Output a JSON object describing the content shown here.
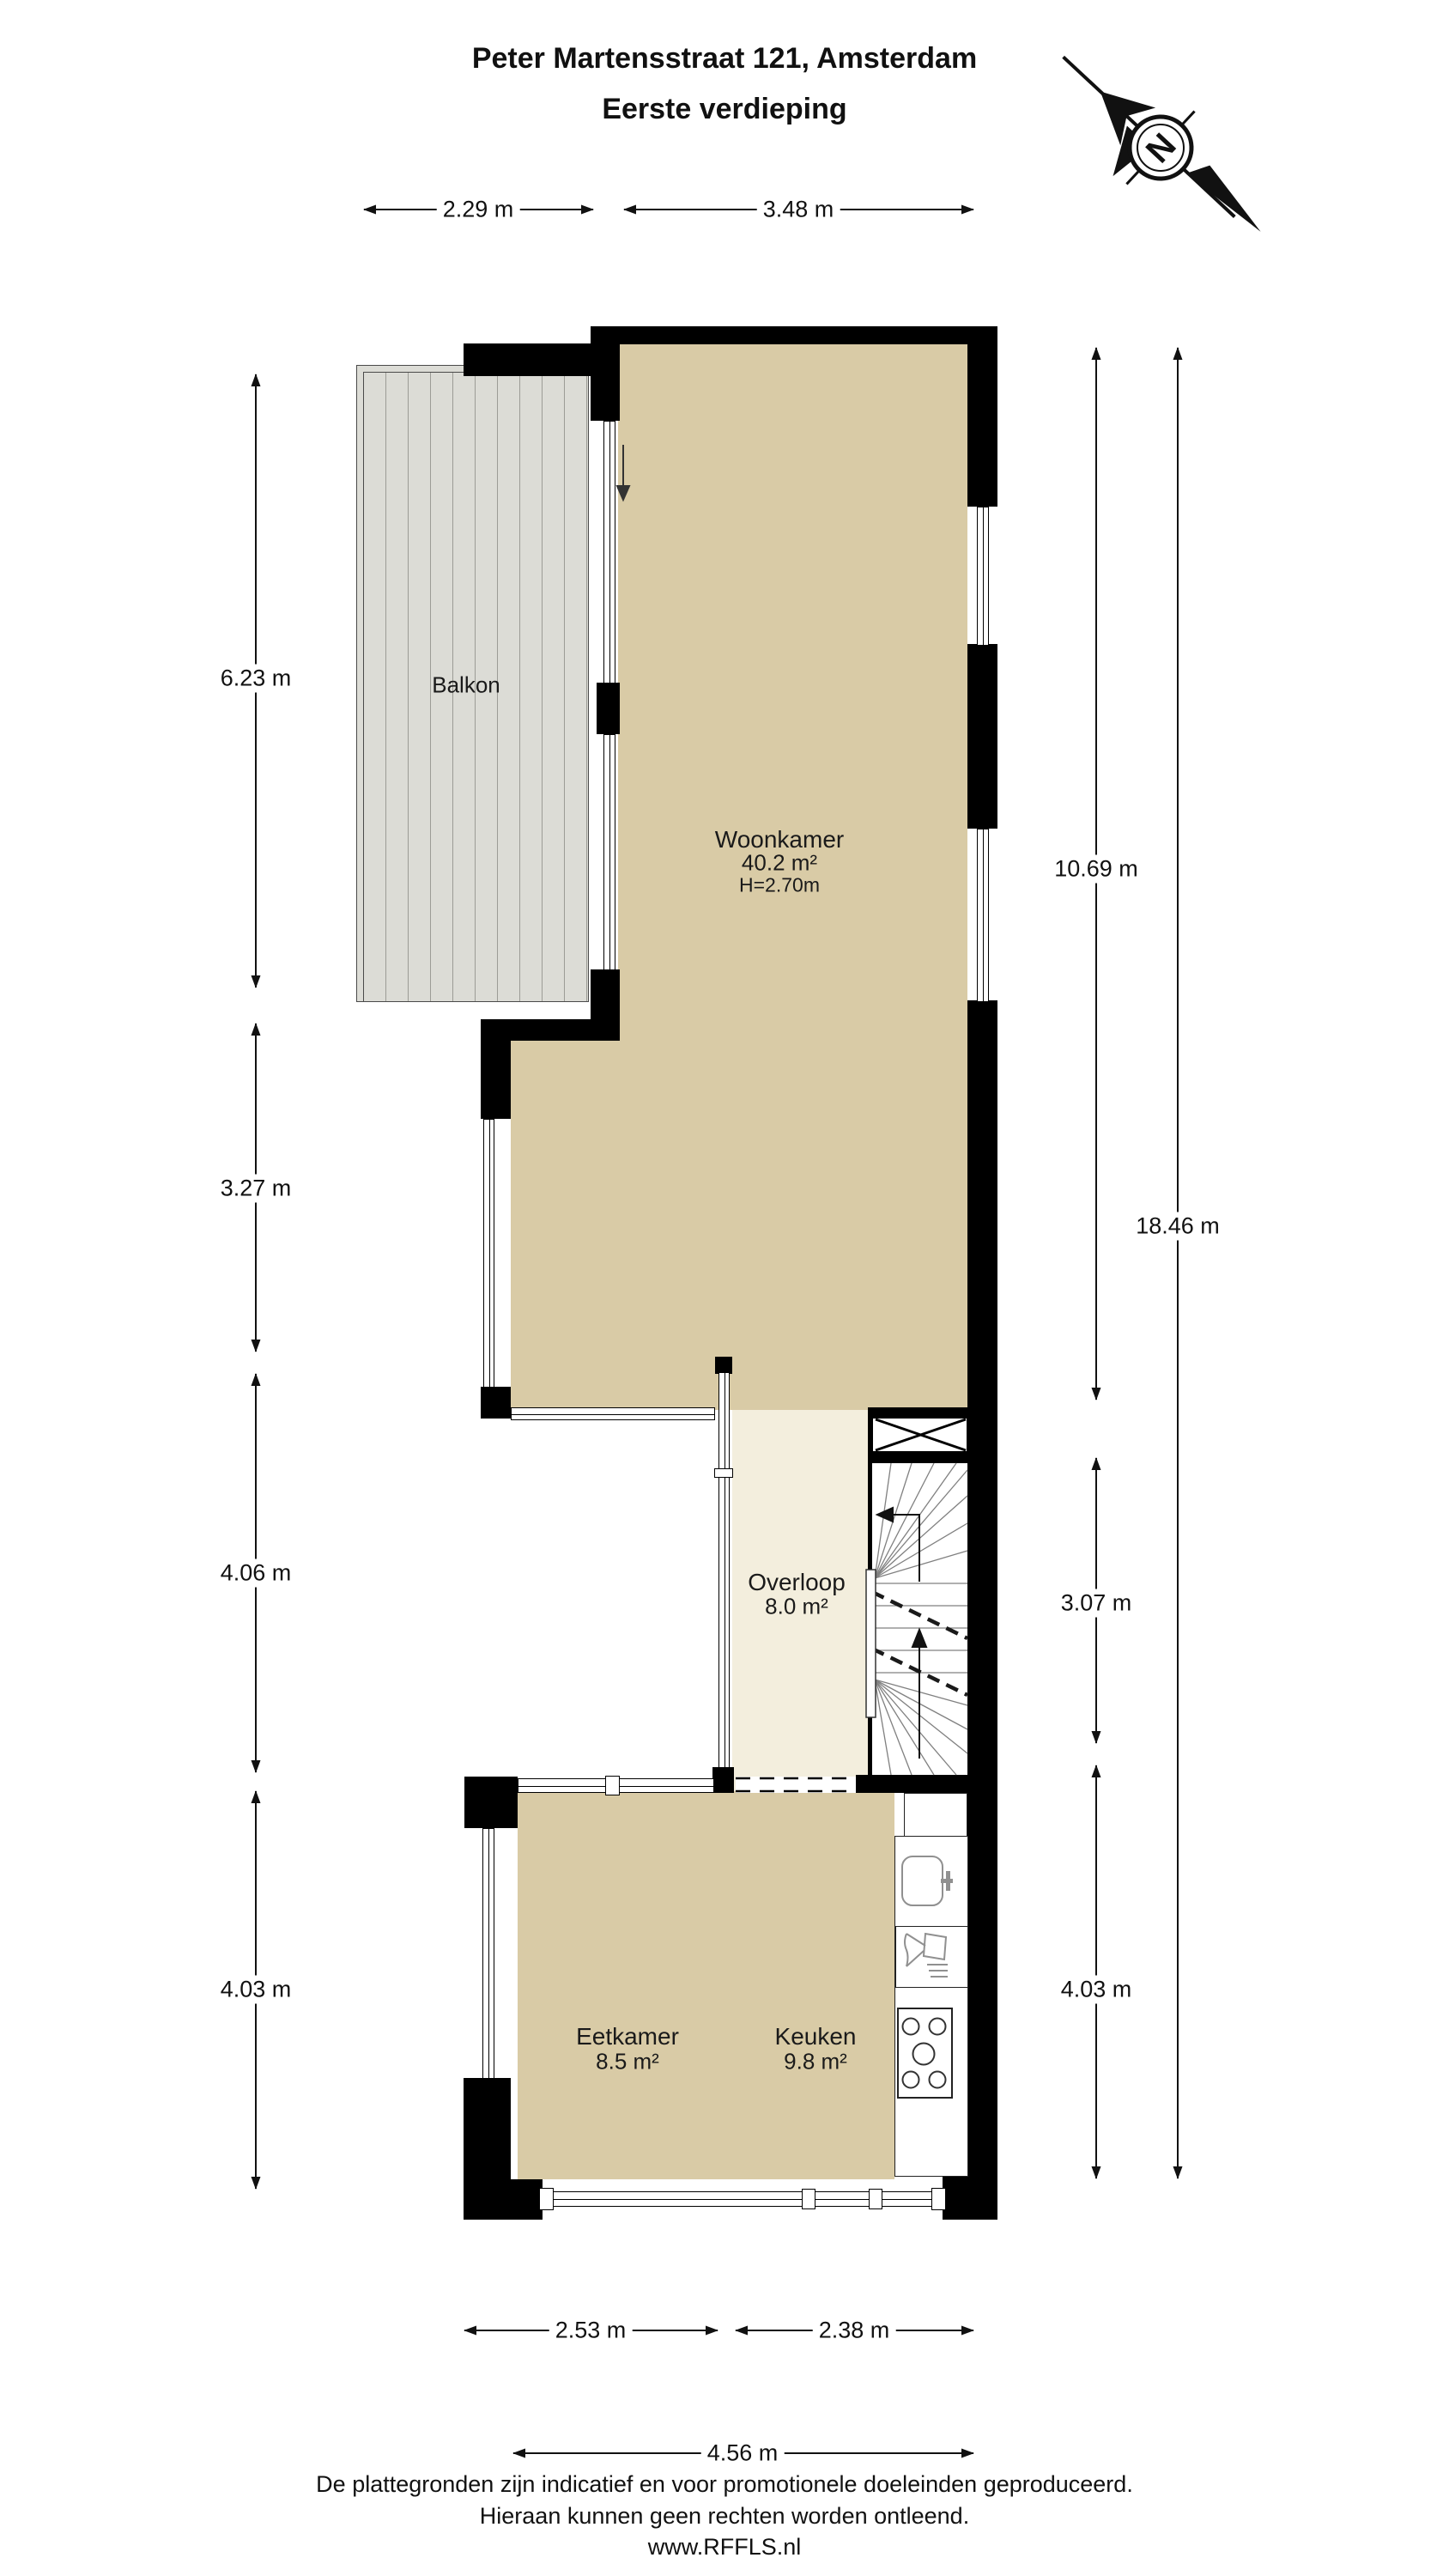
{
  "title": {
    "line1": "Peter Martensstraat 121, Amsterdam",
    "line2": "Eerste verdieping"
  },
  "compass": {
    "label": "N"
  },
  "rooms": {
    "balkon": {
      "name": "Balkon"
    },
    "woonkamer": {
      "name": "Woonkamer",
      "area": "40.2 m²",
      "ceiling": "H=2.70m"
    },
    "overloop": {
      "name": "Overloop",
      "area": "8.0 m²"
    },
    "eetkamer": {
      "name": "Eetkamer",
      "area": "8.5 m²"
    },
    "keuken": {
      "name": "Keuken",
      "area": "9.8 m²"
    }
  },
  "dimensions": {
    "top": [
      {
        "label": "2.29 m"
      },
      {
        "label": "3.48 m"
      }
    ],
    "left": [
      {
        "label": "6.23 m"
      },
      {
        "label": "3.27 m"
      },
      {
        "label": "4.06 m"
      },
      {
        "label": "4.03 m"
      }
    ],
    "right_inner": [
      {
        "label": "10.69 m"
      },
      {
        "label": "3.07 m"
      },
      {
        "label": "4.03 m"
      }
    ],
    "right_outer": [
      {
        "label": "18.46 m"
      }
    ],
    "bottom": [
      {
        "label": "2.53 m"
      },
      {
        "label": "2.38 m"
      },
      {
        "label": "4.56 m"
      }
    ]
  },
  "footer": {
    "line1": "De plattegronden zijn indicatief en voor promotionele doeleinden geproduceerd.",
    "line2": "Hieraan kunnen geen rechten worden ontleend.",
    "line3": "www.RFFLS.nl"
  },
  "colors": {
    "wall": "#000000",
    "floor": "#d9cba6",
    "landing_floor": "#f3eedd",
    "balcony_deck": "#dcdcd6",
    "text": "#111111"
  }
}
